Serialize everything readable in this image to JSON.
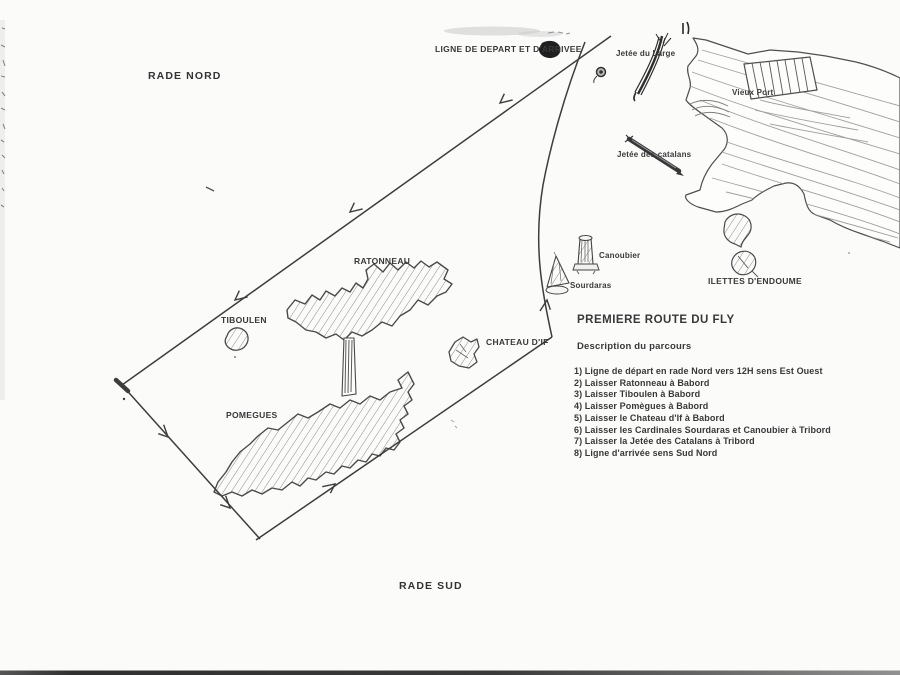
{
  "map": {
    "areas": {
      "rade_nord": "RADE NORD",
      "rade_sud": "RADE SUD"
    },
    "start_line_label": "LIGNE DE DEPART ET D'ARRIVEE",
    "islands": {
      "ratonneau": "RATONNEAU",
      "tiboulen": "TIBOULEN",
      "pomegues": "POMEGUES",
      "chateau_if": "CHATEAU D'IF",
      "ilettes_endoume": "ILETTES D'ENDOUME"
    },
    "cardinal_marks": {
      "canoubier": "Canoubier",
      "sourdaras": "Sourdaras"
    },
    "coast_features": {
      "jetee_du_large": "Jetée du Large",
      "vieux_port": "Vieux Port",
      "jetee_des_catalans": "Jetée des catalans"
    }
  },
  "course": {
    "title": "PREMIERE ROUTE DU FLY",
    "subtitle": "Description du parcours",
    "steps": [
      "1) Ligne de départ en rade Nord vers 12H sens Est Ouest",
      "2) Laisser Ratonneau à Babord",
      "3) Laisser Tiboulen  à Babord",
      "4) Laisser Pomègues à Babord",
      "5) Laisser le Chateau d'If à Babord",
      "6) Laisser les Cardinales Sourdaras et Canoubier à Tribord",
      "7) Laisser la Jetée des Catalans à Tribord",
      "8) Ligne d'arrivée sens Sud Nord"
    ]
  },
  "colors": {
    "ink": "#3a3a3a",
    "pencil": "#909090",
    "paper": "#fbfbfa"
  }
}
